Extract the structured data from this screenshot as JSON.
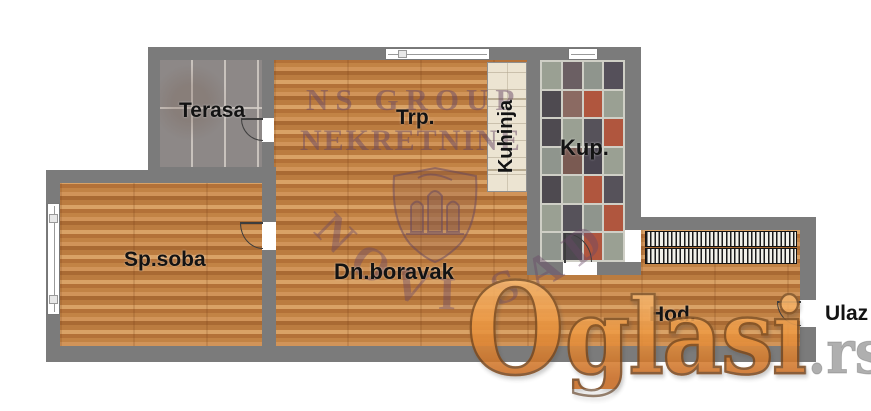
{
  "rooms": {
    "terasa": {
      "label": "Terasa"
    },
    "trpezarija": {
      "label": "Trp."
    },
    "kuhinja": {
      "label": "Kuhinja"
    },
    "kupatilo": {
      "label": "Kup."
    },
    "spavaca_soba": {
      "label": "Sp.soba"
    },
    "dnevni_boravak": {
      "label": "Dn.boravak"
    },
    "hodnik": {
      "label": "Hod."
    },
    "ulaz": {
      "label": "Ulaz"
    }
  },
  "watermarks": {
    "agency_line1": "NS GROUP",
    "agency_line2": "NEKRETNINE",
    "agency_arc": "NOVI SAD",
    "site_name_initial": "O",
    "site_name_rest": "glasi",
    "site_tld": ".rs"
  },
  "colors": {
    "wall": "#7b7b7b",
    "wood_base": "#c08148",
    "terrace_tile": "#8d8887",
    "kitchen_counter": "#ece4d2",
    "kup_grout": "#cfcfc6",
    "watermark_purple": "rgba(104,72,102,0.5)",
    "oglasi_orange_top": "#f9bd77",
    "oglasi_orange_bottom": "#c5661c",
    "oglasi_tld_gray": "rgba(112,112,112,0.66)"
  },
  "kup_tiles": [
    "#9aa093",
    "#6b5f63",
    "#8f958d",
    "#55505a",
    "#4e4a50",
    "#8b6a62",
    "#b0563e",
    "#9aa093",
    "#4e4a50",
    "#9aa093",
    "#56525a",
    "#b0563e",
    "#8f958d",
    "#7a5a52",
    "#4a4550",
    "#9aa093",
    "#4e4a50",
    "#9aa093",
    "#b0563e",
    "#56525a",
    "#9aa093",
    "#56525a",
    "#8f958d",
    "#b0563e",
    "#8f958d",
    "#4e4a50",
    "#b0563e",
    "#9aa093"
  ]
}
